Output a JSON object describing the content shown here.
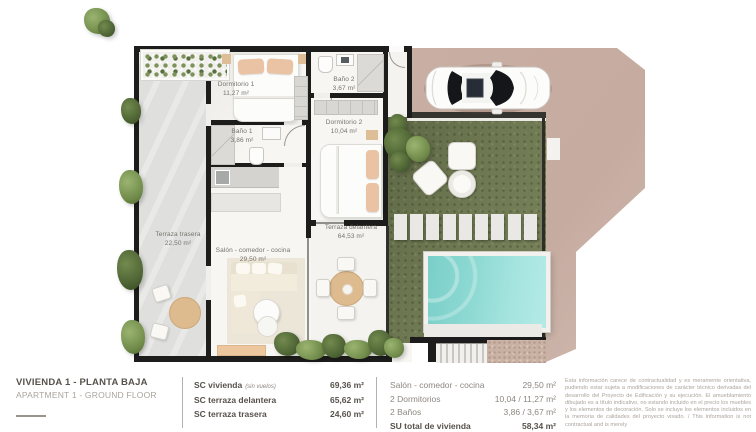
{
  "plan": {
    "labels": {
      "dormitorio1": {
        "name": "Dormitorio 1",
        "area": "11,27 m²"
      },
      "bano1": {
        "name": "Baño 1",
        "area": "3,86 m²"
      },
      "bano2": {
        "name": "Baño 2",
        "area": "3,67 m²"
      },
      "dormitorio2": {
        "name": "Dormitorio 2",
        "area": "10,04 m²"
      },
      "terraza_trasera": {
        "name": "Terraza trasera",
        "area": "22,50 m²"
      },
      "salon": {
        "name": "Salón - comedor - cocina",
        "area": "29,50 m²"
      },
      "terraza_delantera": {
        "name": "Terraza delantera",
        "area": "64,53 m²"
      }
    }
  },
  "footer": {
    "project": {
      "title": "VIVIENDA 1 - PLANTA BAJA",
      "subtitle": "APARTMENT 1 - GROUND FLOOR"
    },
    "sc_table": {
      "rows": [
        {
          "label": "SC vivienda",
          "note": "(sin vuelos)",
          "value": "69,36 m²"
        },
        {
          "label": "SC terraza delantera",
          "note": "",
          "value": "65,62 m²"
        },
        {
          "label": "SC terraza trasera",
          "note": "",
          "value": "24,60 m²"
        }
      ]
    },
    "su_table": {
      "rows": [
        {
          "label": "Salón - comedor - cocina",
          "value": "29,50 m²"
        },
        {
          "label": "2 Dormitorios",
          "value": "10,04 / 11,27 m²"
        },
        {
          "label": "2 Baños",
          "value": "3,86 / 3,67 m²"
        },
        {
          "label": "SU total de vivienda",
          "value": "58,34 m²"
        }
      ]
    },
    "disclaimer": "Esta información carece de contractualidad y es meramente orientativa, pudiendo estar sujeta a modificaciones de carácter técnico derivadas del desarrollo del Proyecto de Edificación y su ejecución. El amueblamiento dibujado es a título indicativo, no estando incluido en el precio los muebles y los elementos de decoración. Solo se incluye los elementos incluidos en la memoria de calidades del proyecto visado. / This information is not contractual and is merely"
  },
  "colors": {
    "driveway": "#c7ada2",
    "garden": "#6e7852",
    "pool_water": "#8fd9d3",
    "wall": "#1d1d1c"
  }
}
